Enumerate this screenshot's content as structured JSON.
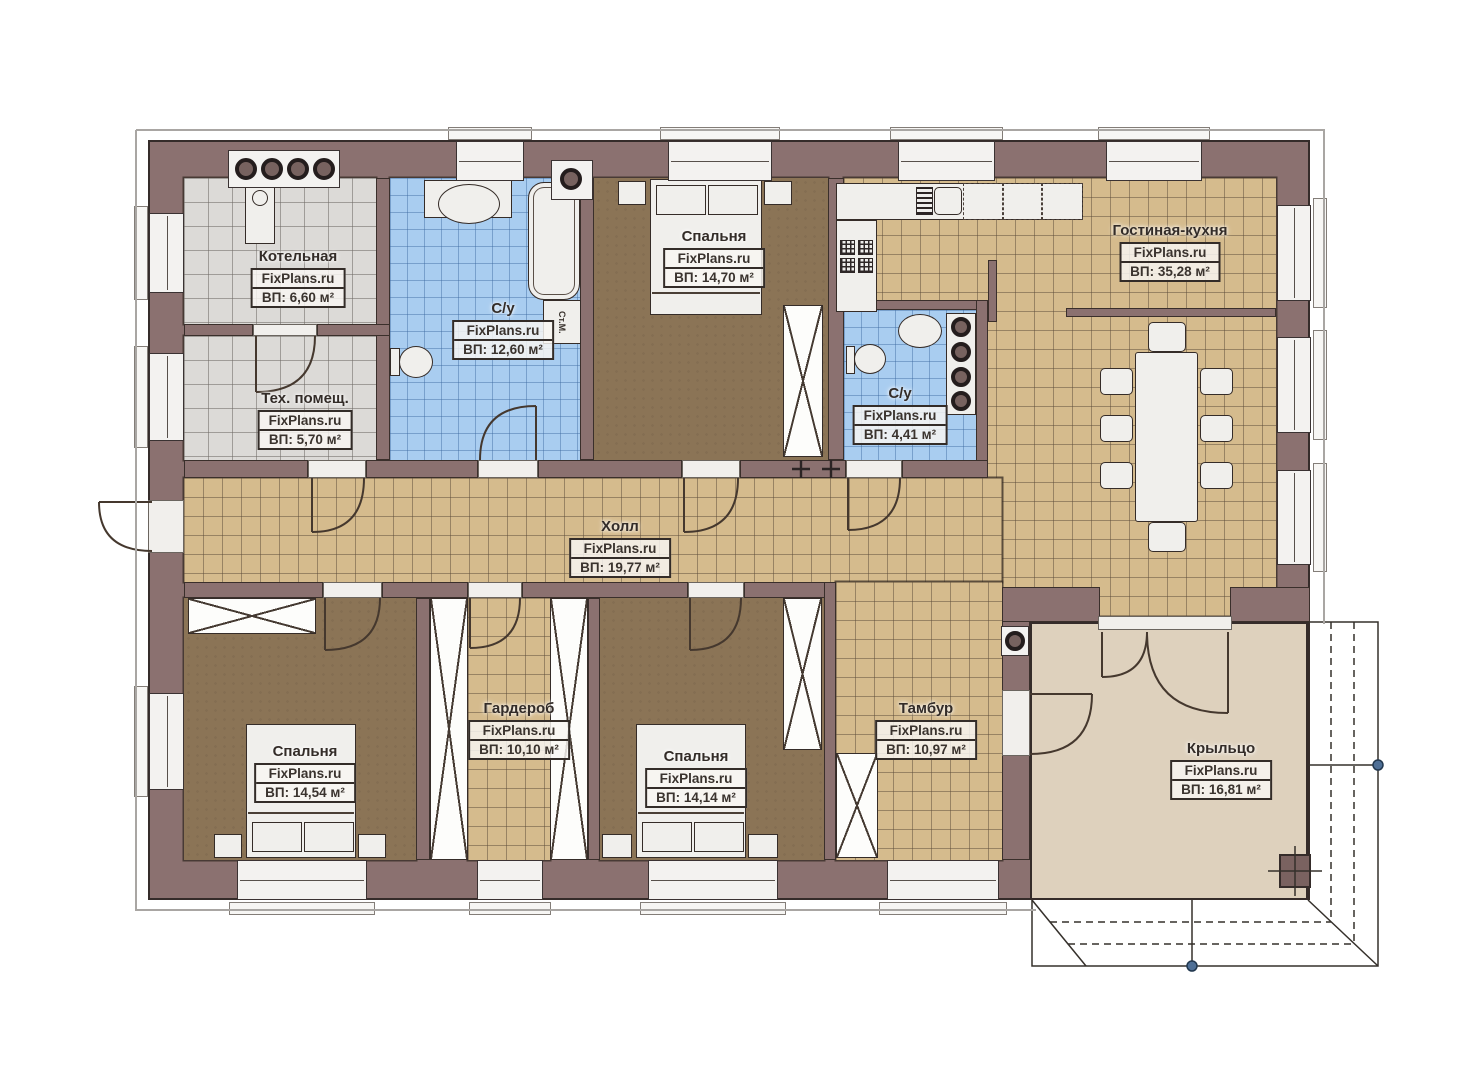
{
  "watermark": "FixPlans.ru",
  "rooms": {
    "boiler": {
      "name": "Котельная",
      "area": "ВП: 6,60 м²"
    },
    "tech_room": {
      "name": "Тех. помещ.",
      "area": "ВП: 5,70 м²"
    },
    "bathroom_main": {
      "name": "С/у",
      "area": "ВП: 12,60 м²"
    },
    "bedroom_top": {
      "name": "Спальня",
      "area": "ВП: 14,70 м²"
    },
    "bathroom_small": {
      "name": "С/у",
      "area": "ВП: 4,41 м²"
    },
    "living_kitchen": {
      "name": "Гостиная-кухня",
      "area": "ВП: 35,28 м²"
    },
    "hall": {
      "name": "Холл",
      "area": "ВП: 19,77 м²"
    },
    "bedroom_left": {
      "name": "Спальня",
      "area": "ВП: 14,54 м²"
    },
    "wardrobe": {
      "name": "Гардероб",
      "area": "ВП: 10,10 м²"
    },
    "bedroom_middle": {
      "name": "Спальня",
      "area": "ВП: 14,14 м²"
    },
    "vestibule": {
      "name": "Тамбур",
      "area": "ВП: 10,97 м²"
    },
    "porch": {
      "name": "Крыльцо",
      "area": "ВП: 16,81 м²"
    }
  },
  "equipment_labels": {
    "washing_machine": "Ст.М."
  },
  "colors": {
    "wall": "#8b7170",
    "floor_tile_tan": "#d5bb8d",
    "floor_tile_gray": "#dcdad7",
    "floor_tile_blue": "#a9cdf0",
    "floor_wood_brown": "#8b7456",
    "floor_porch": "#ded1bd",
    "fixture_white": "#f0efec",
    "outline": "#352c2a"
  }
}
